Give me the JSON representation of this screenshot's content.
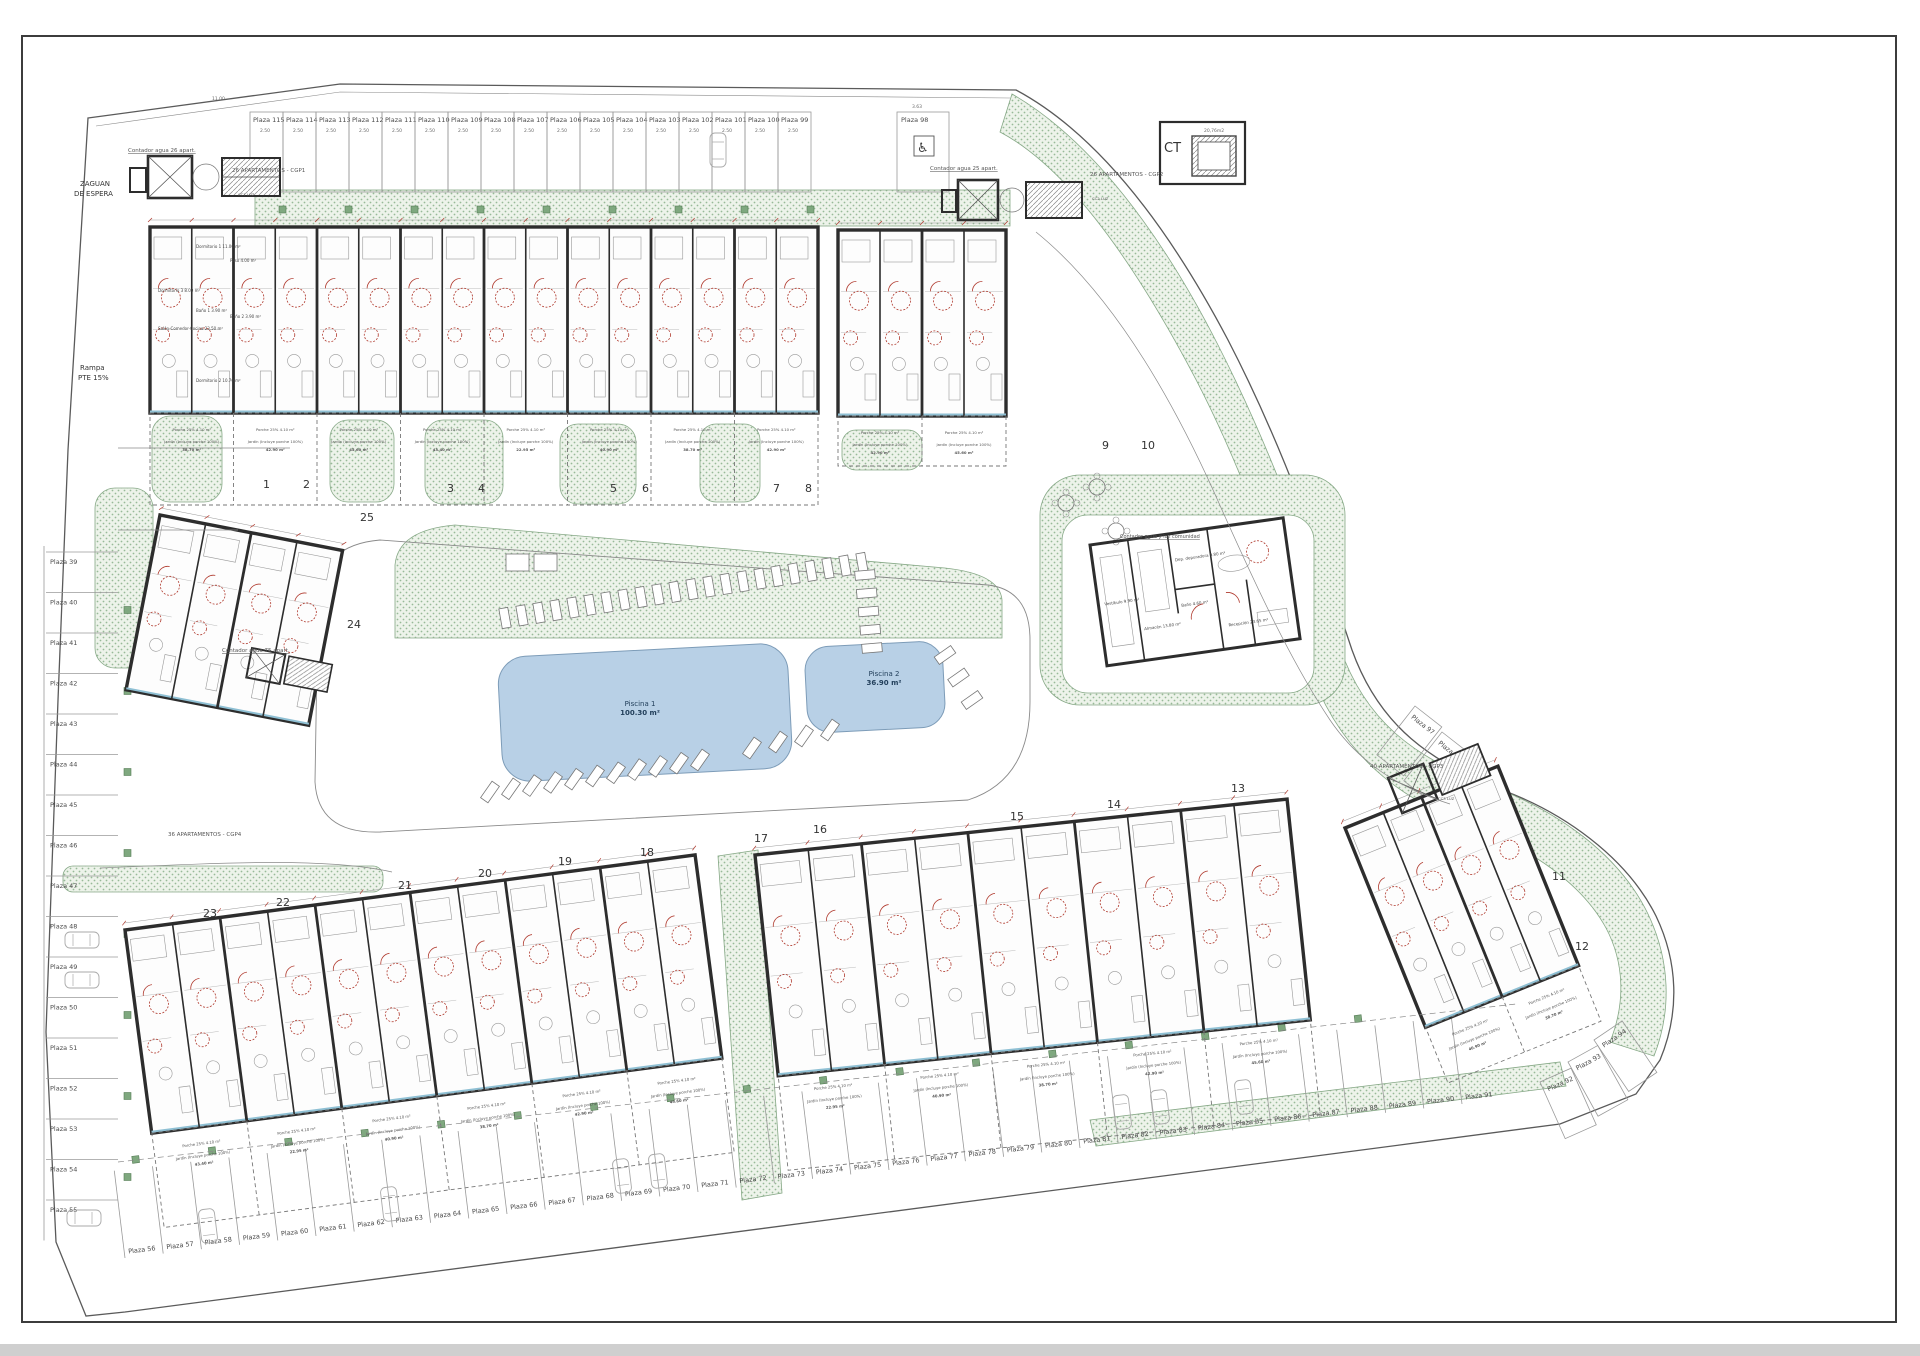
{
  "drawing_title": "Planta general conjunto residencial",
  "annotations": {
    "zaguan_l1": "ZAGUAN",
    "zaguan_l2": "DE ESPERA",
    "rampa_l1": "Rampa",
    "rampa_l2": "PTE 15%",
    "cgp1": "26 APARTAMENTOS - CGP1",
    "cgp2": "26 APARTAMENTOS - CGP2",
    "cgp3": "40 APARTAMENTOS - CGP3",
    "cgp4": "36 APARTAMENTOS - CGP4",
    "contador26": "Contador agua 26 apart.",
    "contador25": "Contador agua 25 apart.",
    "contador75": "Contador agua 75 apart.",
    "contador_com": "Contador agua y luz comunidad",
    "cc1": "CC1 LUZ",
    "cc2": "CC2 LUZ",
    "cc3": "CC3 LUZ",
    "ct": "CT",
    "ct_area": "20,76m2",
    "dim_top": "11.00",
    "dim_handicap": "3.63",
    "dim_stall": "2.50",
    "dim_depth": "5.00"
  },
  "pools": [
    {
      "name": "Piscina 1",
      "area": "100.30 m²",
      "x": 500,
      "y": 650,
      "w": 290,
      "h": 125,
      "rot": -3,
      "lx": 640,
      "ly": 706
    },
    {
      "name": "Piscina 2",
      "area": "36.90 m²",
      "x": 806,
      "y": 644,
      "w": 138,
      "h": 86,
      "rot": -3,
      "lx": 884,
      "ly": 676
    }
  ],
  "typical_unit": {
    "rooms": [
      "Dormitorio 1 11.00 m²",
      "Dormitorio 2 10.70 m²",
      "Dormitorio 3 8.00 m²",
      "Baño 1 3.90 m²",
      "Baño 2 3.90 m²",
      "Paso 4.00 m²",
      "Salón-Comedor-Cocina 23.50 m²"
    ]
  },
  "garden": {
    "porche": "Porche 25%",
    "porche_area": "4.10 m²",
    "jardin": "Jardín (Incluye porche 100%)",
    "areas": [
      "38.70 m²",
      "42.90 m²",
      "45.60 m²",
      "43.40 m²",
      "22.95 m²",
      "40.90 m²"
    ]
  },
  "community": {
    "rooms": [
      "Vestíbulo 9.90 m²",
      "Almacén 13.80 m²",
      "Dep. depuradora 9.80 m²",
      "Recepción 23.65 m²",
      "Baño 4.60 m²"
    ]
  },
  "blocks": [
    {
      "n": "1",
      "x": 263,
      "y": 488
    },
    {
      "n": "2",
      "x": 303,
      "y": 488
    },
    {
      "n": "3",
      "x": 447,
      "y": 492
    },
    {
      "n": "4",
      "x": 478,
      "y": 492
    },
    {
      "n": "5",
      "x": 610,
      "y": 492
    },
    {
      "n": "6",
      "x": 642,
      "y": 492
    },
    {
      "n": "7",
      "x": 773,
      "y": 492
    },
    {
      "n": "8",
      "x": 805,
      "y": 492
    },
    {
      "n": "9",
      "x": 1102,
      "y": 449
    },
    {
      "n": "10",
      "x": 1141,
      "y": 449
    },
    {
      "n": "11",
      "x": 1552,
      "y": 880
    },
    {
      "n": "12",
      "x": 1575,
      "y": 950
    },
    {
      "n": "13",
      "x": 1231,
      "y": 792
    },
    {
      "n": "14",
      "x": 1107,
      "y": 808
    },
    {
      "n": "15",
      "x": 1010,
      "y": 820
    },
    {
      "n": "16",
      "x": 813,
      "y": 833
    },
    {
      "n": "17",
      "x": 754,
      "y": 842
    },
    {
      "n": "18",
      "x": 640,
      "y": 856
    },
    {
      "n": "19",
      "x": 558,
      "y": 865
    },
    {
      "n": "20",
      "x": 478,
      "y": 877
    },
    {
      "n": "21",
      "x": 398,
      "y": 889
    },
    {
      "n": "22",
      "x": 276,
      "y": 906
    },
    {
      "n": "23",
      "x": 203,
      "y": 917
    },
    {
      "n": "24",
      "x": 347,
      "y": 628
    },
    {
      "n": "25",
      "x": 360,
      "y": 521
    }
  ],
  "parking": {
    "top_row": {
      "x0": 250,
      "w": 33,
      "y": 112,
      "h": 80,
      "labels": [
        "Plaza 115",
        "Plaza 114",
        "Plaza 113",
        "Plaza 112",
        "Plaza 111",
        "Plaza 110",
        "Plaza 109",
        "Plaza 108",
        "Plaza 107",
        "Plaza 106",
        "Plaza 105",
        "Plaza 104",
        "Plaza 103",
        "Plaza 102",
        "Plaza 101",
        "Plaza 100",
        "Plaza 99"
      ]
    },
    "handicap": {
      "label": "Plaza 98",
      "x": 897,
      "y": 112,
      "w": 52,
      "h": 80
    },
    "left_col": {
      "x": 46,
      "w": 72,
      "y0": 552,
      "step": 40.5,
      "labels": [
        "Plaza 39",
        "Plaza 40",
        "Plaza 41",
        "Plaza 42",
        "Plaza 43",
        "Plaza 44",
        "Plaza 45",
        "Plaza 46",
        "Plaza 47",
        "Plaza 48",
        "Plaza 49",
        "Plaza 50",
        "Plaza 51",
        "Plaza 52",
        "Plaza 53",
        "Plaza 54",
        "Plaza 55"
      ]
    },
    "bottom_row": {
      "x0": 125,
      "step": 38.2,
      "y0": 1258,
      "dy": -4.4,
      "h": 88,
      "rot": -7,
      "labels": [
        "Plaza 56",
        "Plaza 57",
        "Plaza 58",
        "Plaza 59",
        "Plaza 60",
        "Plaza 61",
        "Plaza 62",
        "Plaza 63",
        "Plaza 64",
        "Plaza 65",
        "Plaza 66",
        "Plaza 67",
        "Plaza 68",
        "Plaza 69",
        "Plaza 70",
        "Plaza 71",
        "Plaza 72",
        "Plaza 73",
        "Plaza 74",
        "Plaza 75",
        "Plaza 76",
        "Plaza 77",
        "Plaza 78",
        "Plaza 79",
        "Plaza 80",
        "Plaza 81",
        "Plaza 82",
        "Plaza 83",
        "Plaza 84",
        "Plaza 85",
        "Plaza 86",
        "Plaza 87",
        "Plaza 88",
        "Plaza 89",
        "Plaza 90",
        "Plaza 91"
      ]
    },
    "right_up": [
      {
        "label": "Plaza 92",
        "x": 1540,
        "y": 1082,
        "rot": -24
      },
      {
        "label": "Plaza 93",
        "x": 1568,
        "y": 1062,
        "rot": -29
      },
      {
        "label": "Plaza 94",
        "x": 1594,
        "y": 1040,
        "rot": -34
      }
    ],
    "diagonal": [
      {
        "label": "Plaza 97",
        "x": 1415,
        "y": 706,
        "rot": 38
      },
      {
        "label": "Plaza 96",
        "x": 1442,
        "y": 732,
        "rot": 38
      },
      {
        "label": "Plaza 95",
        "x": 1468,
        "y": 758,
        "rot": 38
      }
    ]
  },
  "strips": [
    {
      "id": "blocks-1-8",
      "x": 150,
      "y": 227,
      "w": 668,
      "h": 186,
      "rot": 0,
      "units": 16,
      "garden": 92
    },
    {
      "id": "blocks-9-10",
      "x": 838,
      "y": 230,
      "w": 168,
      "h": 186,
      "rot": 0,
      "units": 4,
      "garden": 50
    },
    {
      "id": "blocks-24-25",
      "x": 160,
      "y": 515,
      "w": 186,
      "h": 178,
      "rot": 11,
      "units": 4,
      "garden": 0
    },
    {
      "id": "blocks-18-23",
      "x": 125,
      "y": 930,
      "w": 575,
      "h": 205,
      "rot": -7.5,
      "units": 12,
      "garden": 95
    },
    {
      "id": "blocks-13-17",
      "x": 755,
      "y": 855,
      "w": 535,
      "h": 222,
      "rot": -6,
      "units": 10,
      "garden": 95
    },
    {
      "id": "blocks-11-12",
      "x": 1345,
      "y": 828,
      "w": 165,
      "h": 215,
      "rot": -22,
      "units": 4,
      "garden": 60
    }
  ],
  "loungers": [
    {
      "x0": 505,
      "y0": 618,
      "x1": 862,
      "y1": 563,
      "n": 22,
      "rot": -10
    },
    {
      "x0": 490,
      "y0": 792,
      "x1": 700,
      "y1": 760,
      "n": 11,
      "rot": 35
    },
    {
      "x0": 752,
      "y0": 748,
      "x1": 830,
      "y1": 730,
      "n": 4,
      "rot": 35
    },
    {
      "x0": 865,
      "y0": 575,
      "x1": 872,
      "y1": 648,
      "n": 5,
      "rot": 85
    },
    {
      "x0": 945,
      "y0": 655,
      "x1": 972,
      "y1": 700,
      "n": 3,
      "rot": 55
    }
  ],
  "tables": [
    {
      "x": 1066,
      "y": 503
    },
    {
      "x": 1097,
      "y": 487
    },
    {
      "x": 1116,
      "y": 531
    }
  ],
  "cars": [
    {
      "x": 718,
      "y": 150,
      "rot": 0
    },
    {
      "x": 82,
      "y": 940,
      "rot": 90
    },
    {
      "x": 82,
      "y": 980,
      "rot": 90
    },
    {
      "x": 84,
      "y": 1218,
      "rot": 90
    },
    {
      "x": 208,
      "y": 1226,
      "rot": -7
    },
    {
      "x": 390,
      "y": 1204,
      "rot": -7
    },
    {
      "x": 622,
      "y": 1176,
      "rot": -7
    },
    {
      "x": 658,
      "y": 1171,
      "rot": -7
    },
    {
      "x": 1122,
      "y": 1112,
      "rot": -7
    },
    {
      "x": 1160,
      "y": 1107,
      "rot": -7
    },
    {
      "x": 1244,
      "y": 1097,
      "rot": -7
    }
  ],
  "colors": {
    "wall": "#2d2d2d",
    "thin_line": "#9a9a9a",
    "red_accent": "#b03a2e",
    "pool_fill": "#b8d0e6",
    "pool_edge": "#7d9cb8",
    "green_fill": "#e9f1e6",
    "green_dot": "#8fb48f",
    "green_edge": "#86a886",
    "glazing": "#8fc0d4",
    "paper": "#ffffff"
  }
}
